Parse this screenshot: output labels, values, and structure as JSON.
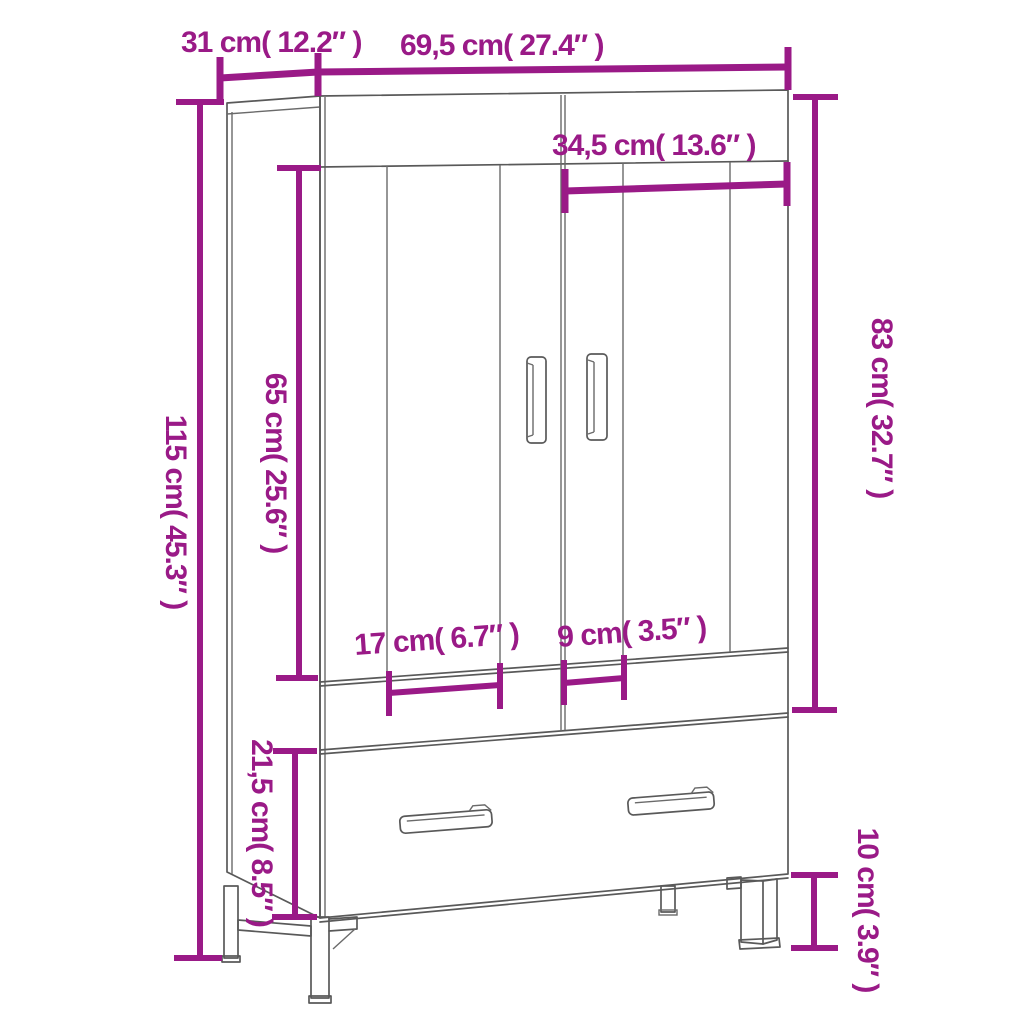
{
  "diagram_title": "Wardrobe dimension drawing",
  "colors": {
    "accent": "#9A1A87",
    "outline": "#595959",
    "background": "#FFFFFF"
  },
  "units": {
    "primary": "cm",
    "secondary": "inches"
  },
  "labels": {
    "depth": "31 cm( 12.2″ )",
    "width": "69,5 cm( 27.4″ )",
    "door_width": "34,5 cm( 13.6″ )",
    "height": "115 cm( 45.3″ )",
    "door_height": "65 cm( 25.6″ )",
    "front_height": "83 cm( 32.7″ )",
    "left_offset": "17 cm( 6.7″ )",
    "right_offset": "9 cm( 3.5″ )",
    "drawer_height": "21,5 cm( 8.5″ )",
    "leg_height": "10 cm( 3.9″ )"
  },
  "measurements": [
    {
      "name": "depth",
      "cm": 31,
      "inch": 12.2
    },
    {
      "name": "width",
      "cm": 69.5,
      "inch": 27.4
    },
    {
      "name": "door_width",
      "cm": 34.5,
      "inch": 13.6
    },
    {
      "name": "height",
      "cm": 115,
      "inch": 45.3
    },
    {
      "name": "door_height",
      "cm": 65,
      "inch": 25.6
    },
    {
      "name": "front_height",
      "cm": 83,
      "inch": 32.7
    },
    {
      "name": "left_offset",
      "cm": 17,
      "inch": 6.7
    },
    {
      "name": "right_offset",
      "cm": 9,
      "inch": 3.5
    },
    {
      "name": "drawer_height",
      "cm": 21.5,
      "inch": 8.5
    },
    {
      "name": "leg_height",
      "cm": 10,
      "inch": 3.9
    }
  ]
}
